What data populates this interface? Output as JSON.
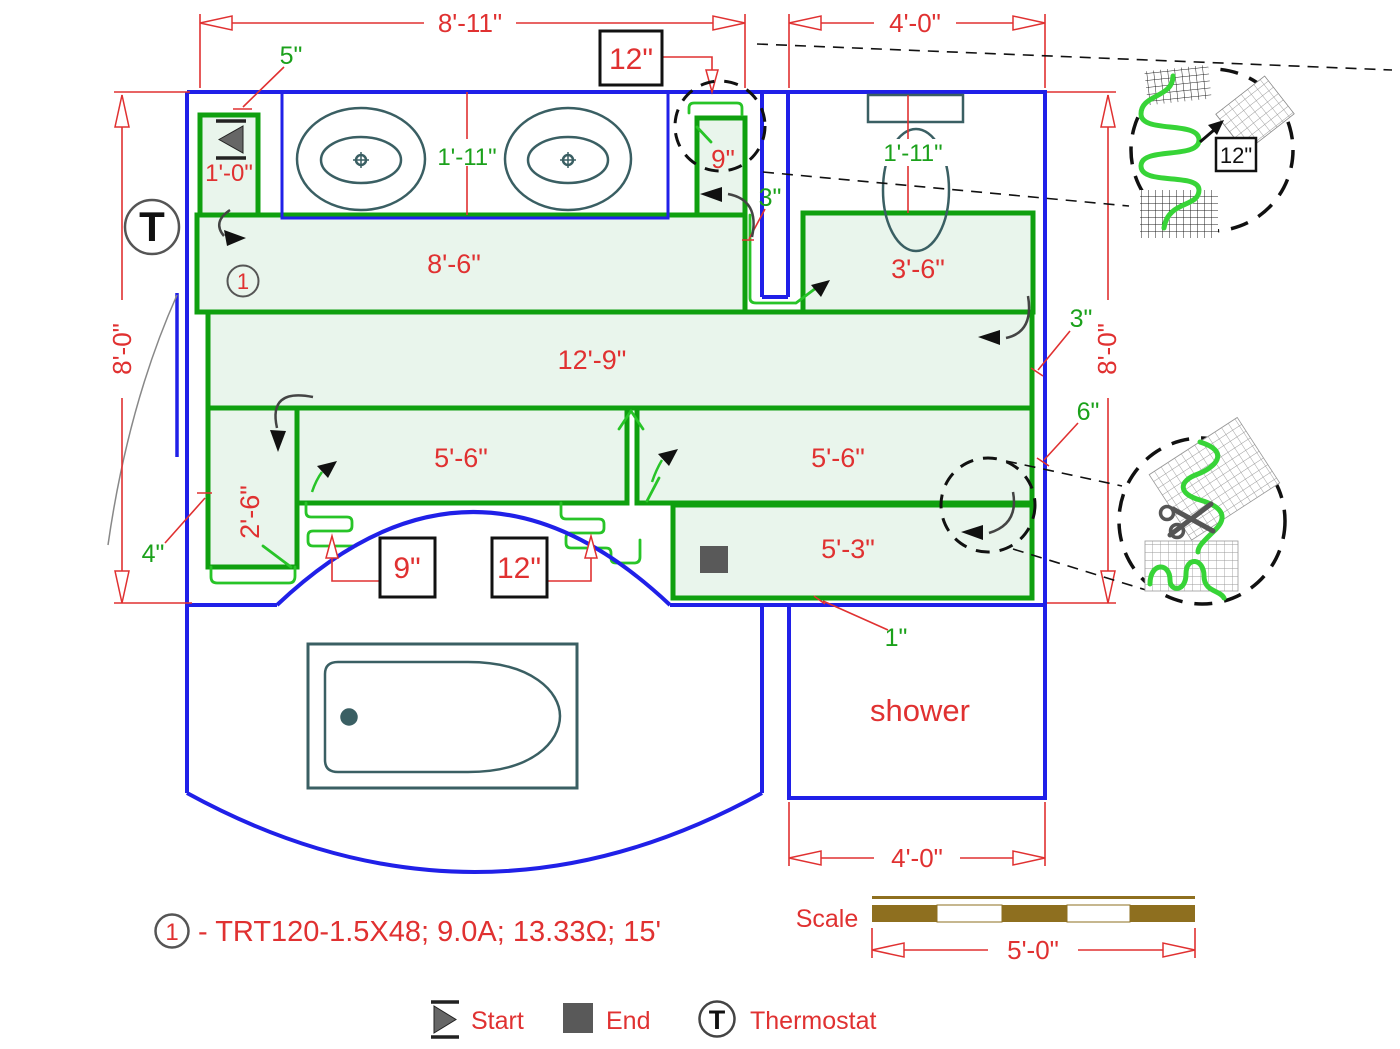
{
  "colors": {
    "wall_blue": "#2020e8",
    "mat_border_green": "#0fa00f",
    "mat_fill_green": "#e9f5ec",
    "cable_green": "#28c428",
    "dim_red": "#e03131",
    "label_green": "#1ba11b",
    "fixture_teal": "#3a5f63",
    "scale_brown": "#8e6f1f",
    "end_marker_gray": "#595959"
  },
  "dimensions": {
    "top_width": "8'-11\"",
    "toilet_area_width": "4'-0\"",
    "left_height": "8'-0\"",
    "right_height": "8'-0\"",
    "shower_width": "4'-0\"",
    "scale_length": "5'-0\""
  },
  "mat_labels": {
    "start_strip": "1'-0\"",
    "top_band": "8'-6\"",
    "right_top_mat": "3'-6\"",
    "middle_band": "12'-9\"",
    "left_strip": "2'-6\"",
    "lower_left_mat": "5'-6\"",
    "lower_right_mat": "5'-6\"",
    "bottom_mat": "5'-3\"",
    "top_right_strip": "9\""
  },
  "offsets": {
    "vanity_gap": "5\"",
    "sink_centerline": "1'-11\"",
    "toilet_centerline": "1'-11\"",
    "stub_gap": "3\"",
    "right_gap_top": "3\"",
    "right_gap_mid": "6\"",
    "wall_gap": "4\"",
    "bottom_gap": "1\"",
    "spacing_box_top": "12\"",
    "spacing_box_9": "9\"",
    "spacing_box_12": "12\"",
    "detail_spacing": "12\""
  },
  "rooms": {
    "shower": "shower"
  },
  "scale_block": {
    "label": "Scale"
  },
  "note": {
    "circle": "1",
    "text": "- TRT120-1.5X48; 9.0A; 13.33Ω; 15'"
  },
  "legend": {
    "start": "Start",
    "end": "End",
    "thermostat_symbol": "T",
    "thermostat": "Thermostat"
  },
  "plan": {
    "mat_number": "1",
    "thermostat_symbol": "T"
  }
}
